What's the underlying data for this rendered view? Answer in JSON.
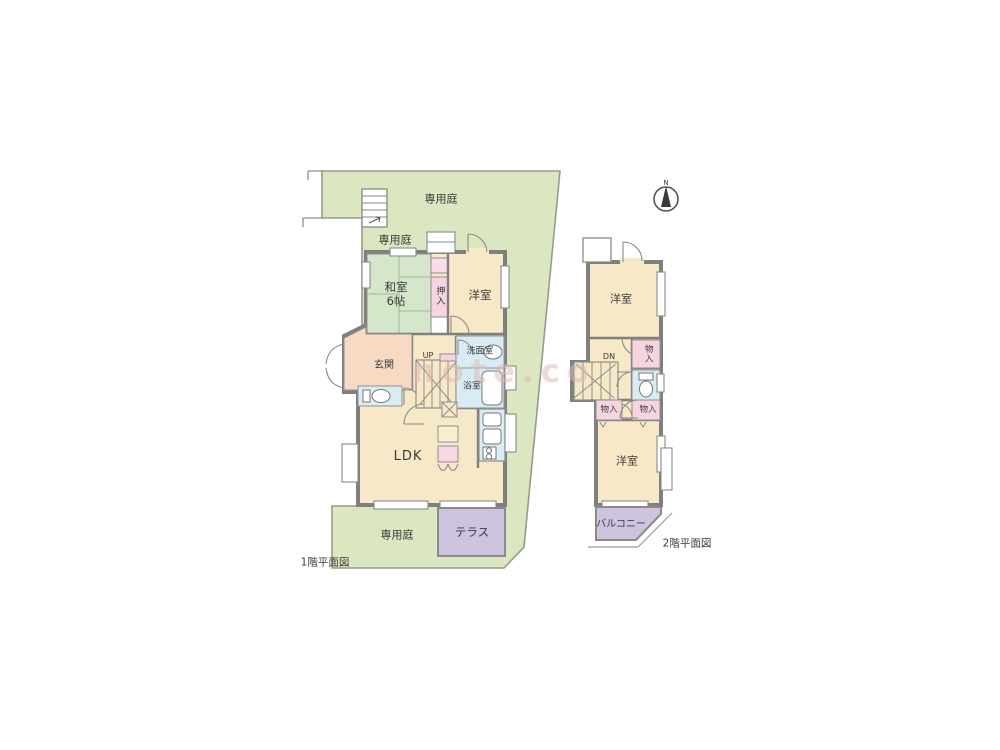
{
  "floor1": {
    "caption": "1階平面図",
    "garden_top": "専用庭",
    "garden_mid": "専用庭",
    "garden_bottom": "専用庭",
    "washitsu": "和室\n6帖",
    "oshiire": "押入",
    "yoshitsu": "洋室",
    "genkan": "玄関",
    "stairs_up": "UP",
    "senmenshitsu": "洗面室",
    "yokushitsu": "浴室",
    "ldk": "LDK",
    "terrace": "テラス"
  },
  "floor2": {
    "caption": "2階平面図",
    "yoshitsu_top": "洋室",
    "stairs_dn": "DN",
    "monoire_top": "物入",
    "monoire_left": "物入",
    "monoire_right": "物入",
    "yoshitsu_bottom": "洋室",
    "balcony": "バルコニー"
  },
  "compass": {
    "label": "N"
  },
  "watermark": "note.co",
  "colors": {
    "garden": "#dbe7c0",
    "room": "#f7e8c7",
    "tatami_room": "#d5e6cb",
    "entrance": "#f8d9c4",
    "closet_pink": "#f6d4e0",
    "wet_blue": "#d9ecf3",
    "terrace_purple": "#cec4df",
    "wall_gray": "#7f7f7f"
  }
}
